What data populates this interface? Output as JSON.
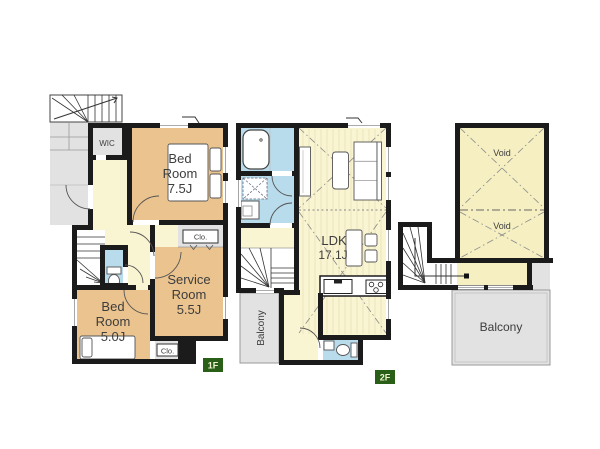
{
  "floor1": {
    "badge": "1F",
    "wic_label": "WIC",
    "bedroom_75": [
      "Bed",
      "Room",
      "7.5J"
    ],
    "service_room": [
      "Service",
      "Room",
      "5.5J"
    ],
    "bedroom_50": [
      "Bed",
      "Room",
      "5.0J"
    ],
    "closet_upper": "Clo.",
    "closet_lower": "Clo."
  },
  "floor2": {
    "badge": "2F",
    "ldk": [
      "LDK",
      "17.1J"
    ],
    "balcony": "Balcony"
  },
  "attic": {
    "void_upper": "Void",
    "void_lower": "Void",
    "balcony": "Balcony"
  },
  "colors": {
    "room_tan": "#eac38e",
    "floor_yellow": "#f9f5d2",
    "void_yellow": "#f5efc2",
    "wet_blue": "#b9dcec",
    "outdoor_gray": "#e2e2e2",
    "wall": "#1b1b1b",
    "badge_green": "#2a5f17",
    "badge_text": "#eef2cf"
  }
}
